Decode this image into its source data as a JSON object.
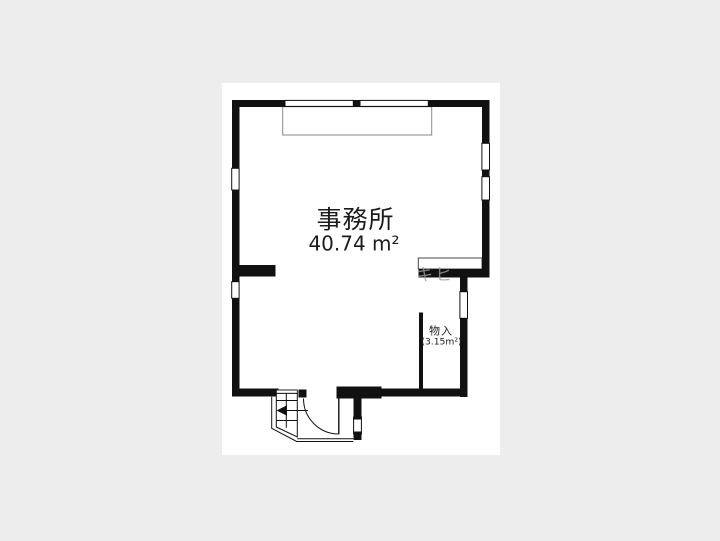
{
  "canvas": {
    "background": "#ededed",
    "paper_color": "#ffffff",
    "wall_color": "#111111"
  },
  "floorplan": {
    "room": {
      "name": "事務所",
      "area": "40.74 m²"
    },
    "closet": {
      "name": "物入",
      "area": "(3.15m²)"
    },
    "watermark": "キヒ"
  }
}
